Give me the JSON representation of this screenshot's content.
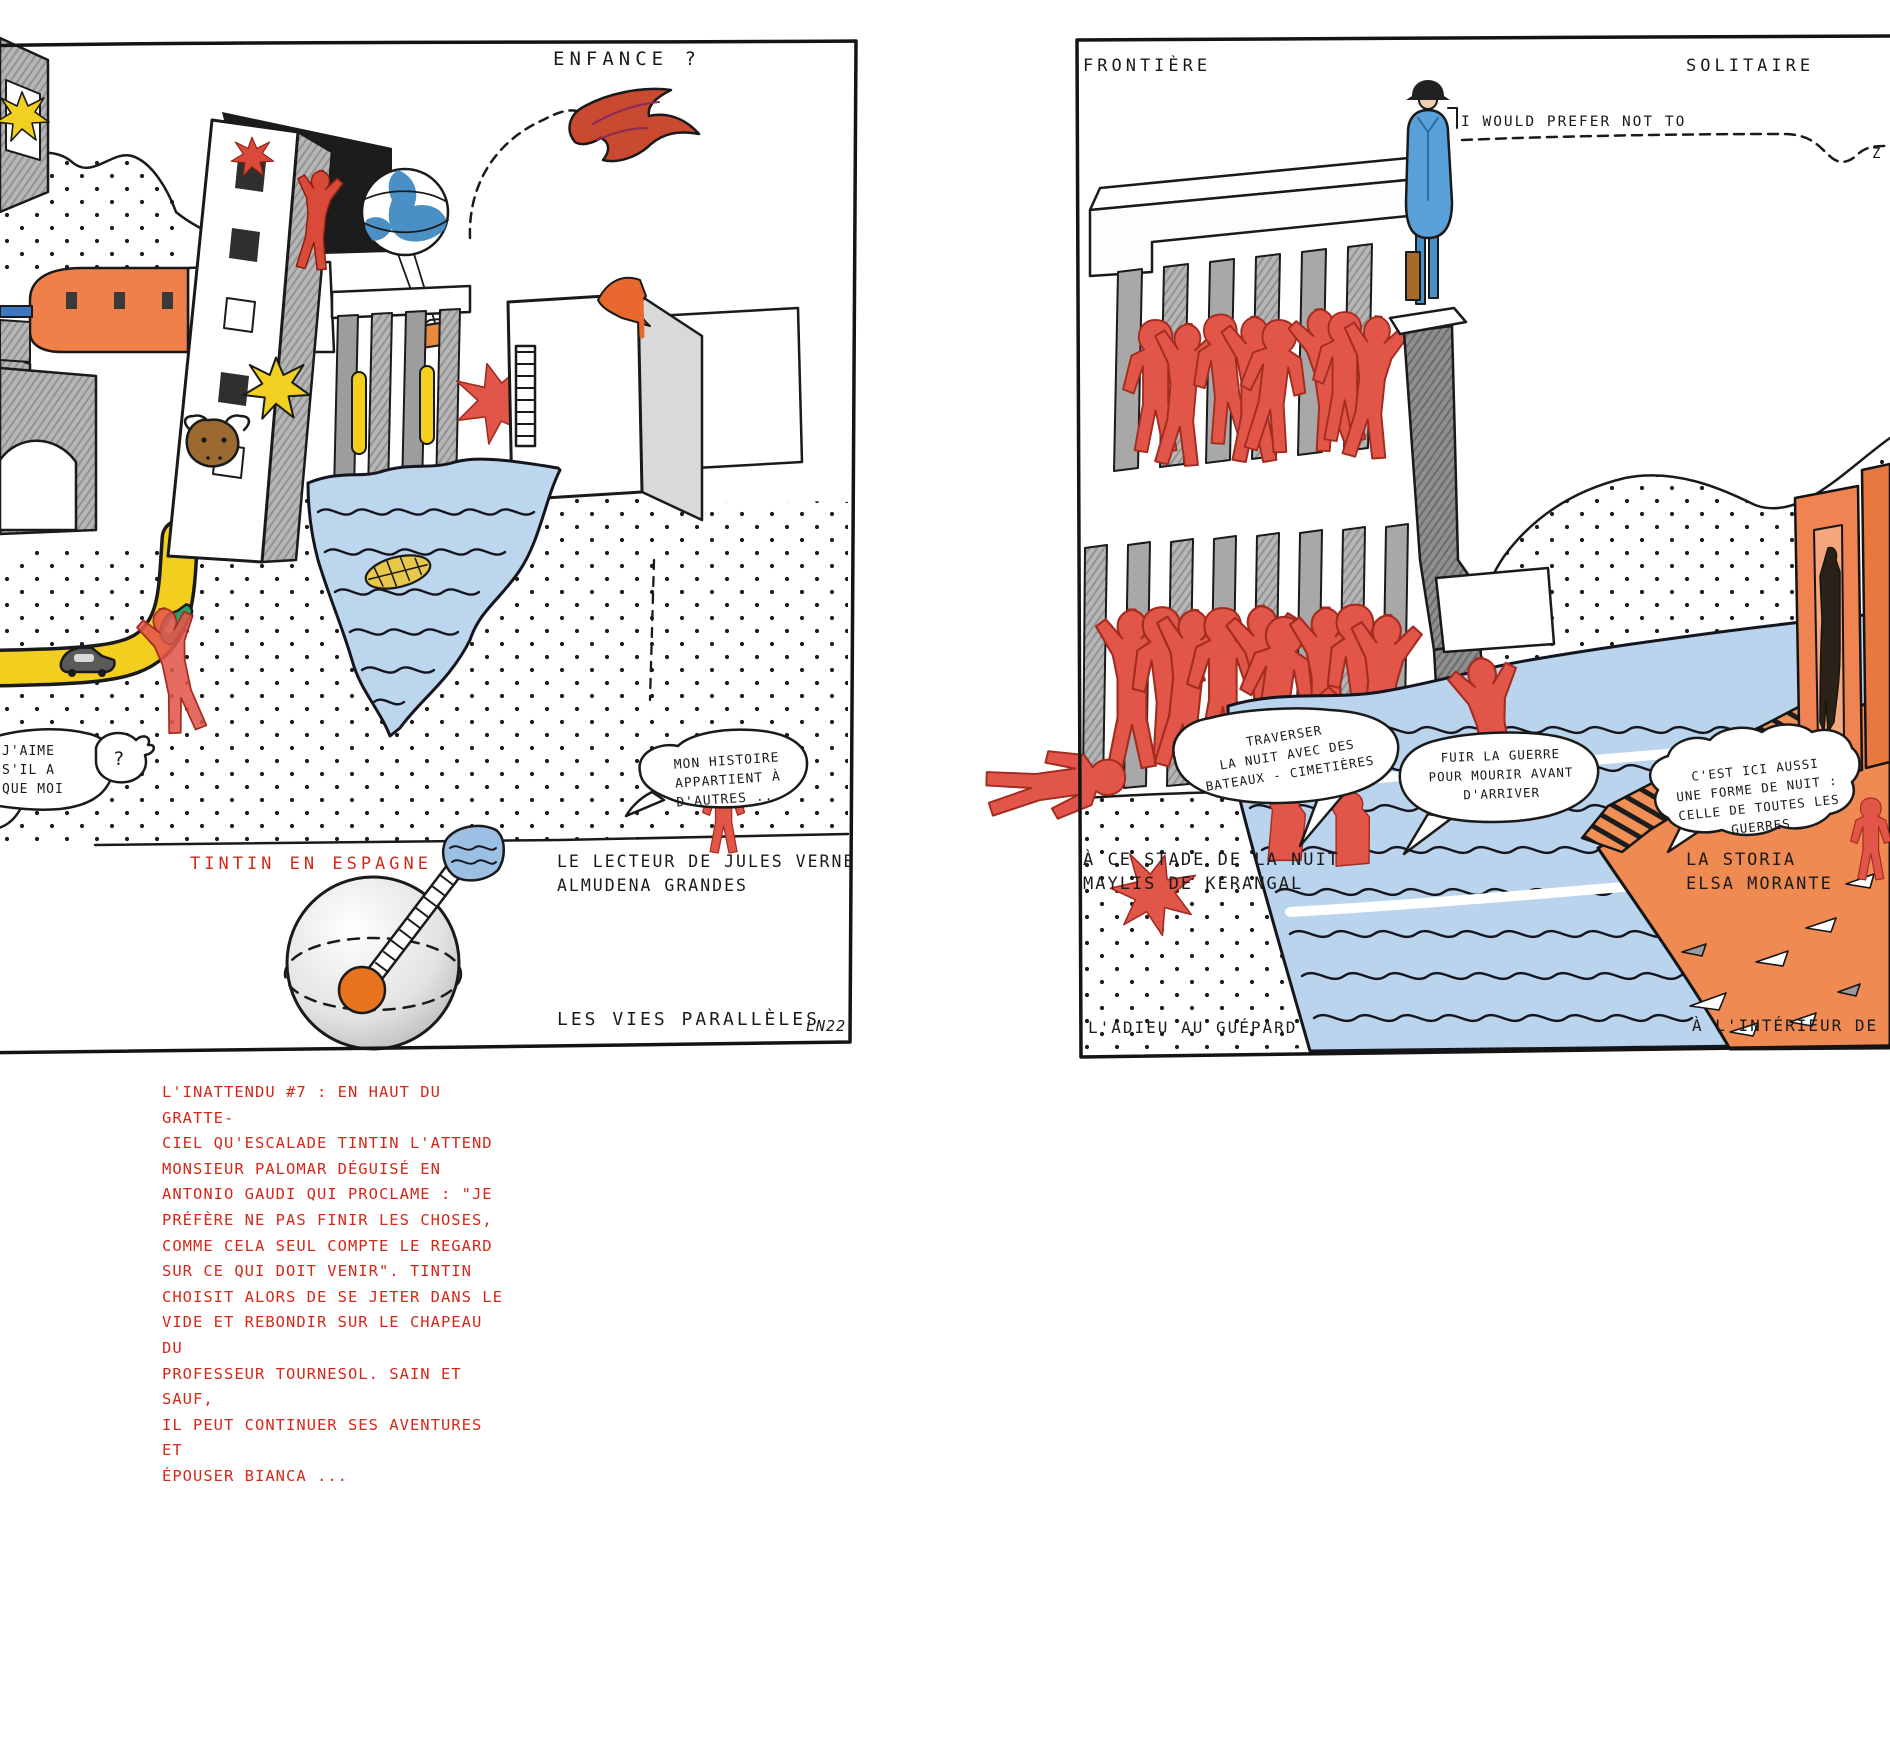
{
  "artwork": {
    "type": "hand-drawn illustrated double page",
    "signature": "LN22"
  },
  "left_panel": {
    "title": "ENFANCE ?",
    "bubble_jaime": "J'AIME\nS'IL A\nQUE MOI",
    "bubble_question": "?",
    "bubble_histoire": "MON HISTOIRE\nAPPARTIENT À\nD'AUTRES ...",
    "label_tintin": "TINTIN EN ESPAGNE",
    "caption_lecteur": "LE LECTEUR DE JULES VERNE\nALMUDENA GRANDES",
    "caption_vies": "LES VIES PARALLÈLES",
    "note": "L'INATTENDU #7 : EN HAUT DU GRATTE-\nCIEL QU'ESCALADE TINTIN L'ATTEND\nMONSIEUR PALOMAR DÉGUISÉ EN\nANTONIO GAUDI QUI PROCLAME : \"JE\nPRÉFÈRE NE PAS FINIR LES CHOSES,\nCOMME CELA SEUL COMPTE LE REGARD\nSUR CE QUI DOIT VENIR\". TINTIN\nCHOISIT ALORS DE SE JETER DANS LE\nVIDE ET REBONDIR SUR LE CHAPEAU DU\nPROFESSEUR TOURNESOL. SAIN ET SAUF,\nIL PEUT CONTINUER SES AVENTURES ET\nÉPOUSER BIANCA ..."
  },
  "right_panel": {
    "label_frontiere": "FRONTIÈRE",
    "label_solitaire": "SOLITAIRE",
    "quote_bartleby": "I WOULD PREFER NOT TO",
    "quote_z": "Z",
    "bubble_traverser": "TRAVERSER\nLA NUIT AVEC DES\nBATEAUX - CIMETIÈRES",
    "bubble_fuir": "FUIR LA GUERRE\nPOUR MOURIR AVANT\nD'ARRIVER",
    "bubble_cest": "C'EST ICI AUSSI\nUNE FORME DE NUIT :\nCELLE DE TOUTES LES\nGUERRES",
    "caption_stade": "À CE STADE DE LA NUIT\nMAYLIS DE KERANGAL",
    "caption_storia": "LA STORIA\nELSA MORANTE",
    "caption_adieu": "L'ADIEU AU GUÉPARD",
    "caption_interieur": "À L'INTÉRIEUR DE SOI"
  },
  "colors": {
    "ink": "#1a1a1a",
    "red_note": "#d3291b",
    "figure_red": "#e2564a",
    "crayon_orange": "#ef8a52",
    "water_blue": "#b9d4ec",
    "star_yellow": "#f2d021",
    "paper": "#ffffff"
  }
}
